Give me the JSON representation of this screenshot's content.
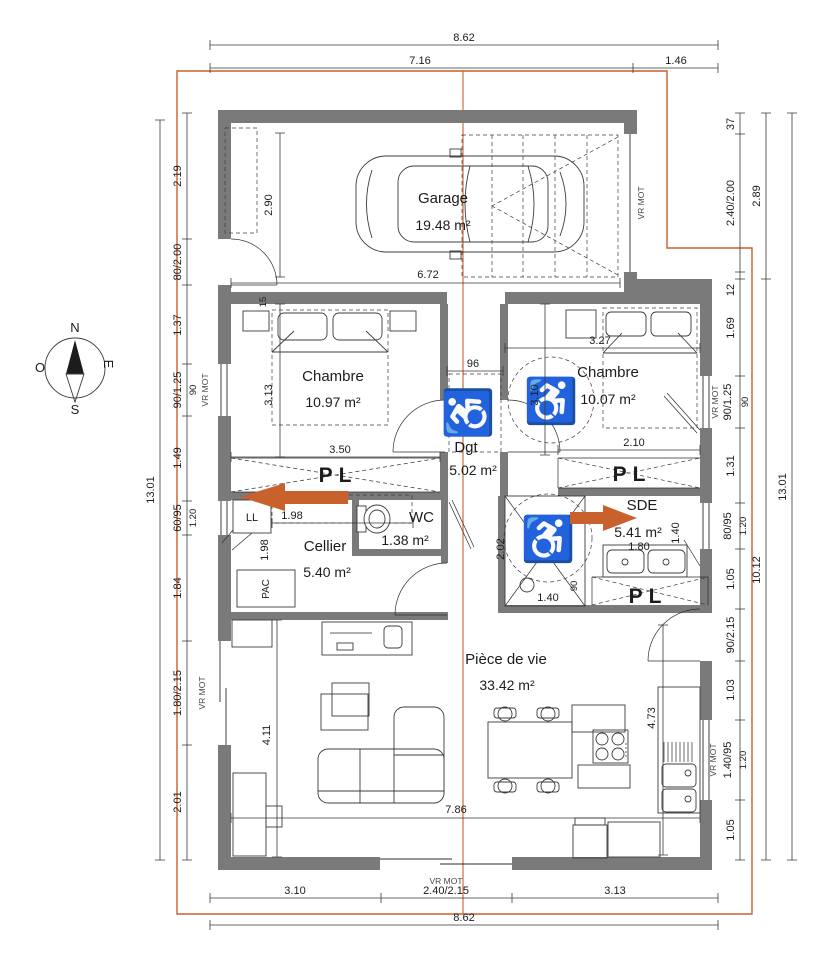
{
  "colors": {
    "wall": "#7a7a7a",
    "accent": "#c8612c",
    "line": "#2e2e2e"
  },
  "icons": {
    "wheelchair": "♿"
  },
  "compass": {
    "north": "N",
    "south": "S",
    "west": "O",
    "east": "E"
  },
  "labels": {
    "vr_mot": "VR MOT",
    "closet": "PL",
    "washer": "LL",
    "heat_pump": "PAC"
  },
  "rooms": {
    "garage": {
      "name": "Garage",
      "area": "19.48 m²"
    },
    "chambre1": {
      "name": "Chambre",
      "area": "10.97 m²"
    },
    "chambre2": {
      "name": "Chambre",
      "area": "10.07 m²"
    },
    "dgt": {
      "name": "Dgt",
      "area": "5.02 m²"
    },
    "cellier": {
      "name": "Cellier",
      "area": "5.40 m²"
    },
    "wc": {
      "name": "WC",
      "area": "1.38 m²"
    },
    "sde": {
      "name": "SDE",
      "area": "5.41 m²"
    },
    "piece_de_vie": {
      "name": "Pièce de vie",
      "area": "33.42 m²"
    }
  },
  "dims": {
    "top": {
      "total": "8.62",
      "left": "7.16",
      "right": "1.46"
    },
    "bottom": {
      "left": "3.10",
      "center": "2.40/2.15",
      "right": "3.13",
      "total": "8.62"
    },
    "left_outer": "13.01",
    "left": [
      "2.19",
      "80/2.00",
      "1.37",
      "90/1.25",
      "1.49",
      "60/95",
      "1.84",
      "1.80/2.15",
      "2.01"
    ],
    "left_sub": {
      "window_width": "90",
      "sill": "1.20"
    },
    "right": [
      "37",
      "2.40/2.00",
      "12",
      "1.69",
      "90/1.25",
      "1.31",
      "80/95",
      "1.05",
      "90/2.15",
      "1.03",
      "1.40/95",
      "1.05"
    ],
    "right_sub": {
      "window_width": "90",
      "sill_a": "1.20",
      "sill_b": "1.20"
    },
    "right_mid": {
      "upper": "2.89",
      "lower": "10.12"
    },
    "right_outer": "13.01",
    "garage": {
      "width": "6.72",
      "height": "2.90"
    },
    "chambre1": {
      "height": "3.13",
      "closet": "3.50",
      "wall": "15"
    },
    "dgt": {
      "passage": "96"
    },
    "chambre2": {
      "width": "3.27",
      "height": "3.10",
      "closet": "2.10"
    },
    "cellier": {
      "width": "1.98",
      "height": "1.98"
    },
    "sde": {
      "height": "2.02",
      "shower": "1.40",
      "shower_depth": "90",
      "vanity": "1.80",
      "door": "1.40"
    },
    "living": {
      "height": "4.11",
      "width": "7.86",
      "kitchen": "4.73"
    }
  }
}
